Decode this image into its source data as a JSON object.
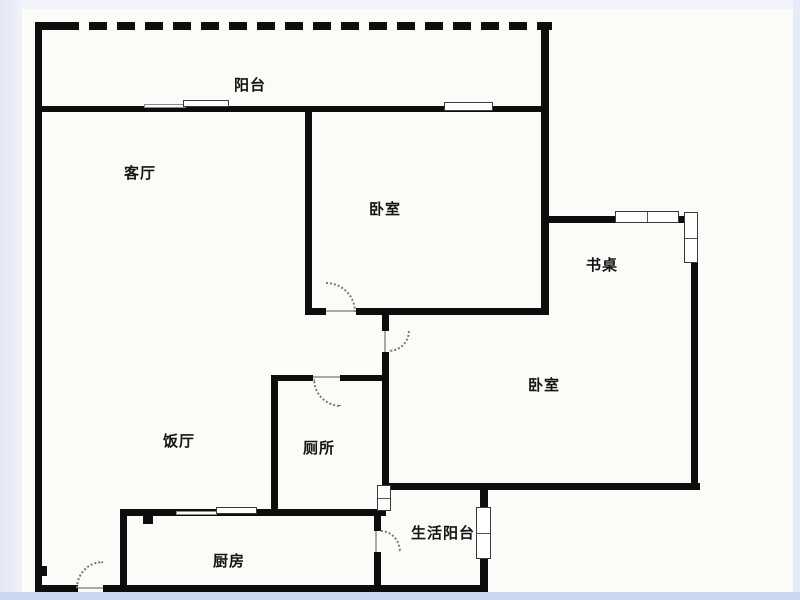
{
  "title": "户型图",
  "rooms": [
    {
      "key": "balcony",
      "label": "阳台",
      "x": 234,
      "y": 77
    },
    {
      "key": "living-room",
      "label": "客厅",
      "x": 124,
      "y": 165
    },
    {
      "key": "bedroom-top",
      "label": "卧室",
      "x": 369,
      "y": 201
    },
    {
      "key": "desk",
      "label": "书桌",
      "x": 586,
      "y": 257
    },
    {
      "key": "bedroom-right",
      "label": "卧室",
      "x": 528,
      "y": 377
    },
    {
      "key": "dining-room",
      "label": "饭厅",
      "x": 163,
      "y": 433
    },
    {
      "key": "toilet",
      "label": "厕所",
      "x": 303,
      "y": 440
    },
    {
      "key": "service-balcony",
      "label": "生活阳台",
      "x": 411,
      "y": 525
    },
    {
      "key": "kitchen",
      "label": "厨房",
      "x": 213,
      "y": 553
    }
  ],
  "colors": {
    "wall": "#0d0d0d",
    "page": "#fbfbf8",
    "margin_left": "#e2e6f6",
    "margin_right": "#e7ebf8",
    "margin_top": "#f2f4fb",
    "band_bottom": "#c9d6ee"
  }
}
